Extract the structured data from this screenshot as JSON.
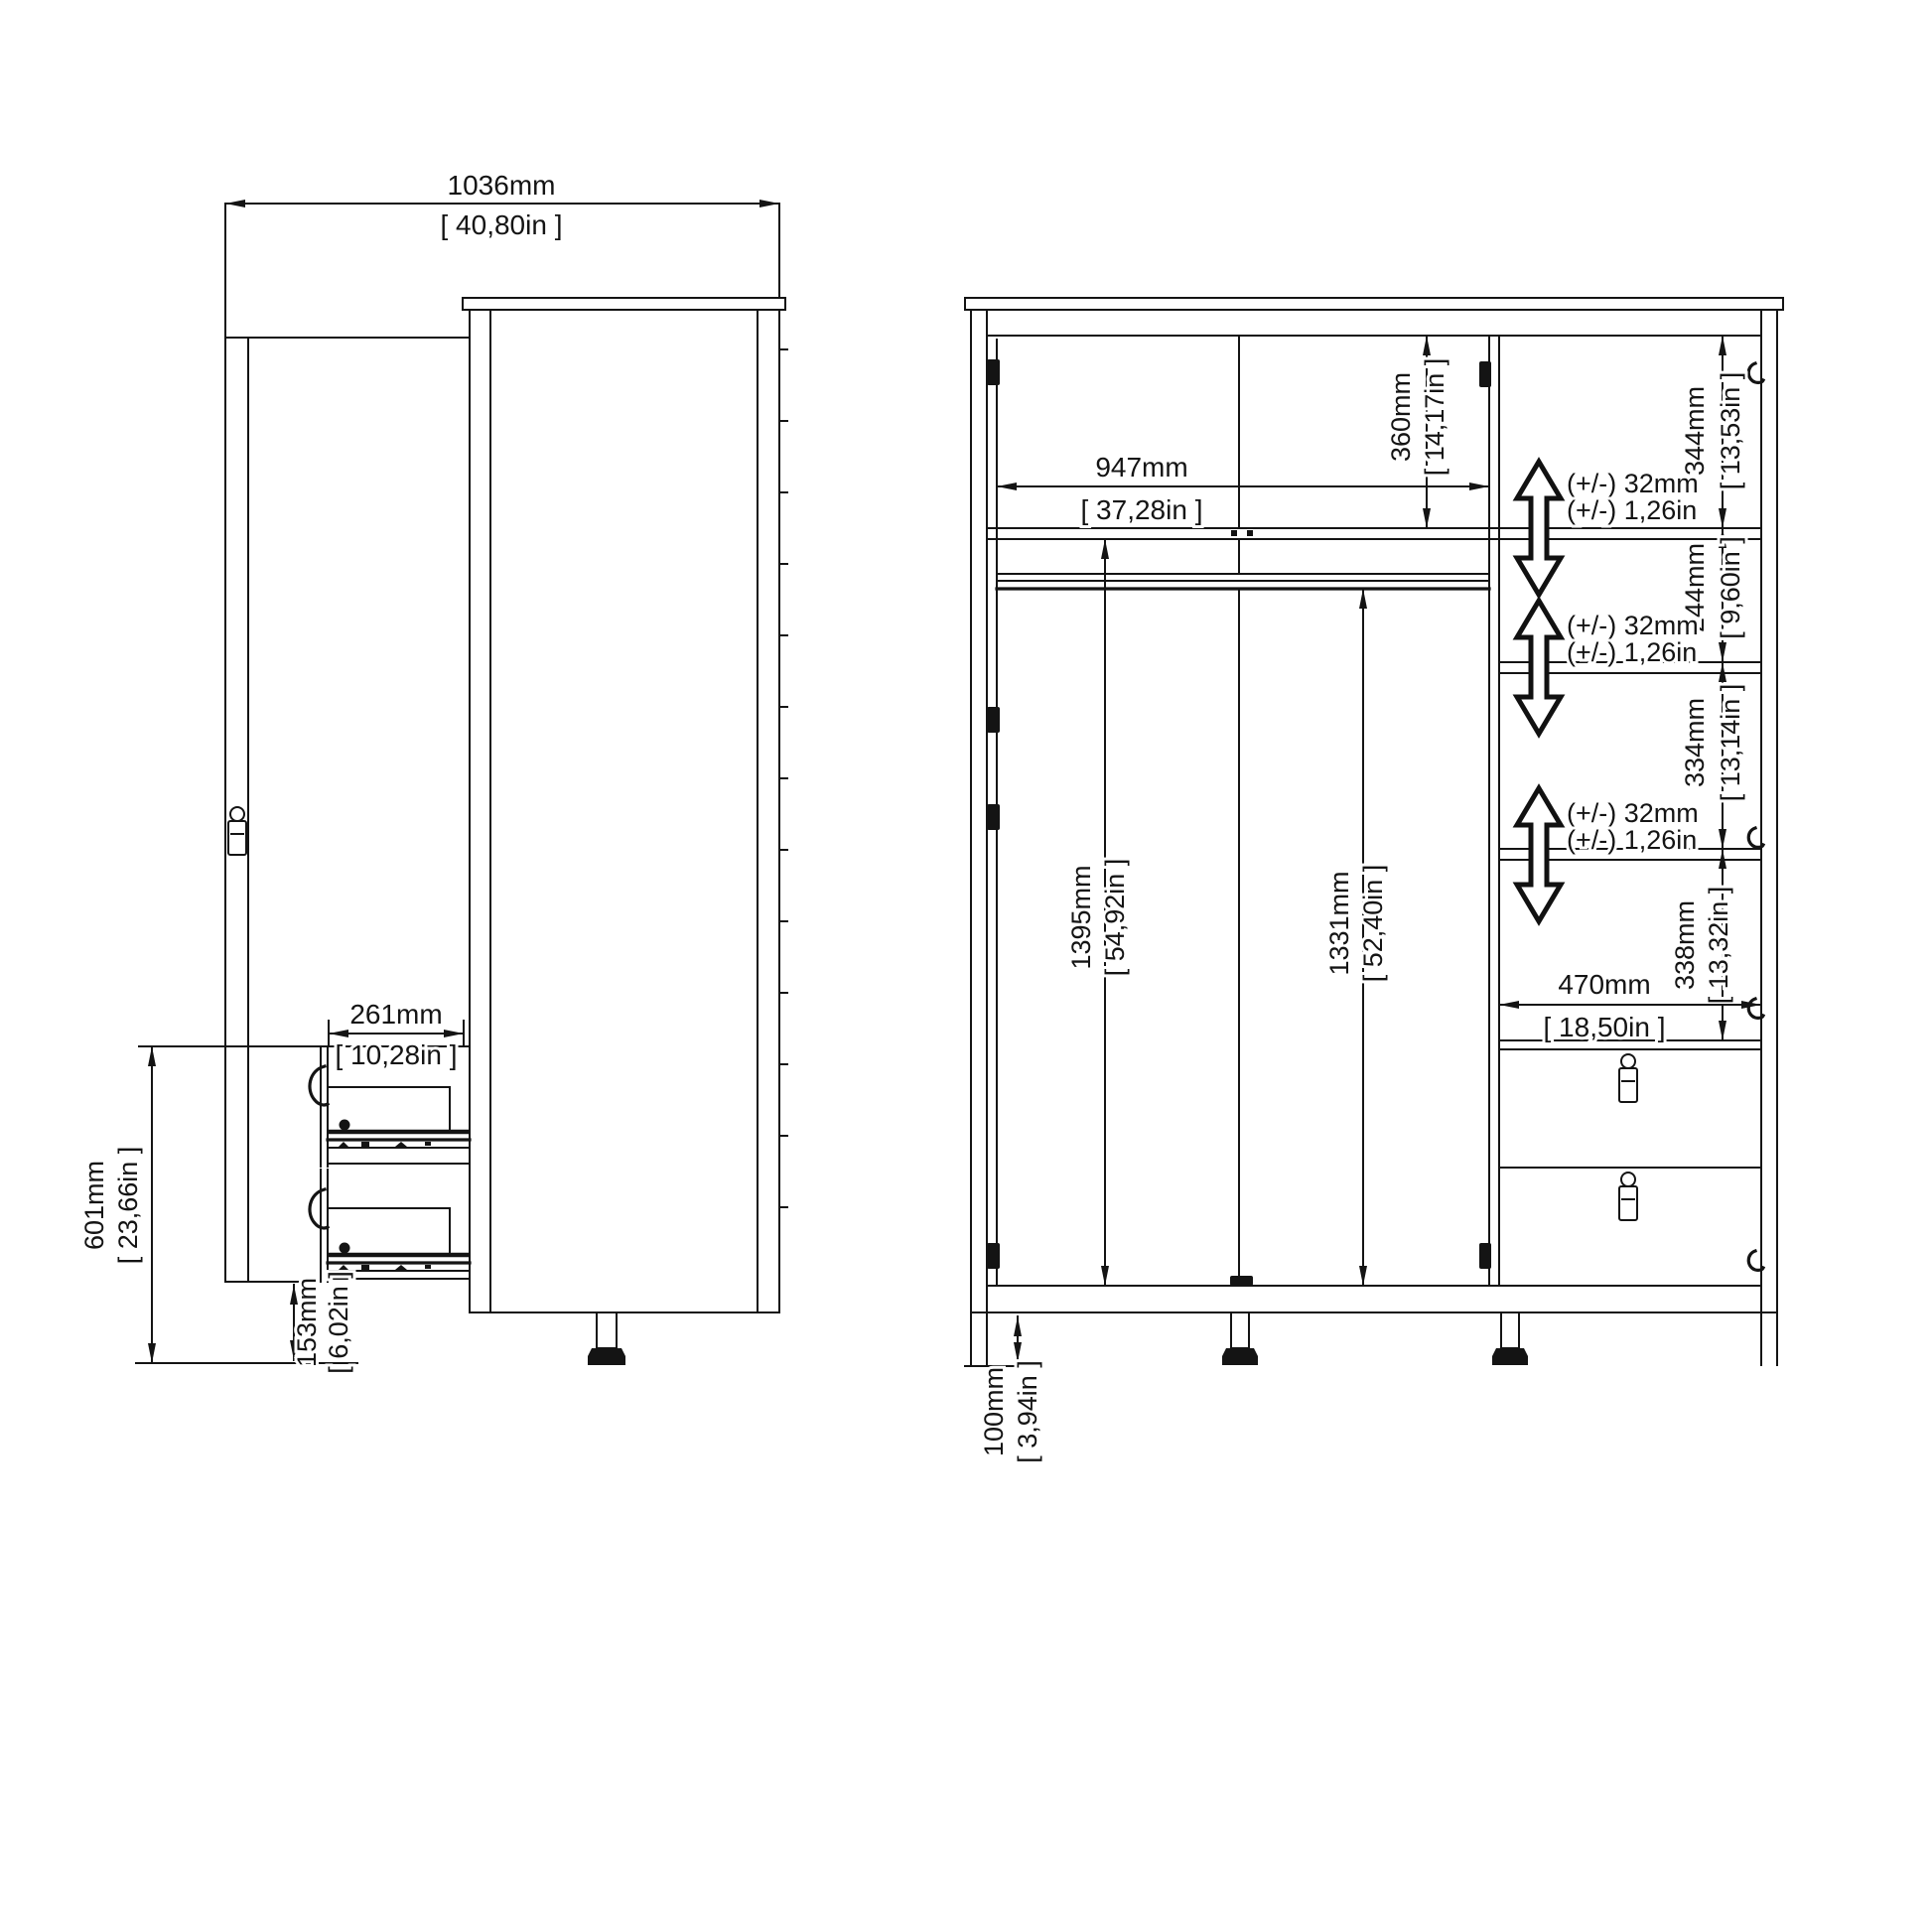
{
  "drawing": {
    "type": "furniture-technical-drawing",
    "subject": "3-door 2-drawer wardrobe dimension diagram",
    "background": "#ffffff",
    "line_color": "#141414"
  },
  "side": {
    "width_mm": "1036mm",
    "width_in": "[ 40,80in ]",
    "drawer_depth_mm": "261mm",
    "drawer_depth_in": "[ 10,28in ]",
    "drawer_unit_mm": "601mm",
    "drawer_unit_in": "[ 23,66in ]",
    "plinth_mm": "153mm",
    "plinth_in": "[ 6,02in ]"
  },
  "front": {
    "inner_width_mm": "947mm",
    "inner_width_in": "[ 37,28in ]",
    "top_section_mm": "360mm",
    "top_section_in": "[ 14,17in ]",
    "hang_left_mm": "1395mm",
    "hang_left_in": "[ 54,92in ]",
    "hang_mid_mm": "1331mm",
    "hang_mid_in": "[ 52,40in ]",
    "gap1_mm": "344mm",
    "gap1_in": "[ 13,53in ]",
    "gap2_mm": "244mm",
    "gap2_in": "[ 9,60in ]",
    "gap3_mm": "334mm",
    "gap3_in": "[ 13,14in ]",
    "gap4_mm": "338mm",
    "gap4_in": "[ 13,32in ]",
    "col_width_mm": "470mm",
    "col_width_in": "[ 18,50in ]",
    "leg_mm": "100mm",
    "leg_in": "[ 3,94in ]",
    "adjust_mm": "(+/-) 32mm",
    "adjust_in": "(+/-) 1,26in"
  }
}
